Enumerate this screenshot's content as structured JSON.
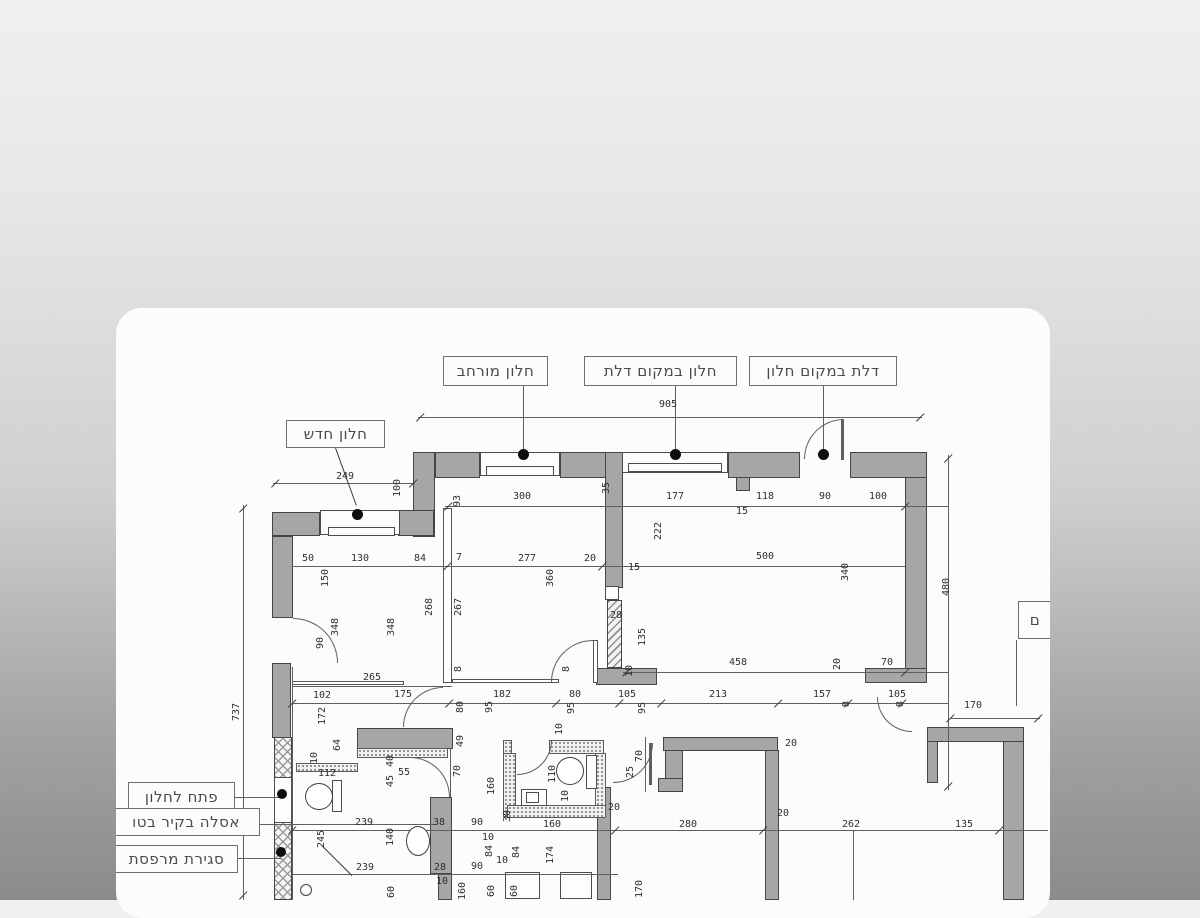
{
  "scene": {
    "background_top": "#f0f0f0",
    "background_bottom": "#8b8b8b",
    "card_color": "#fcfcfc",
    "wall_fill": "#a6a6a6",
    "ink": "#454545"
  },
  "plan": {
    "callouts": [
      {
        "t": "חלון מורחב",
        "x": 443,
        "y": 356,
        "w": 105,
        "h": 30
      },
      {
        "t": "חלון במקום דלת",
        "x": 584,
        "y": 356,
        "w": 153,
        "h": 30
      },
      {
        "t": "דלת במקום חלון",
        "x": 749,
        "y": 356,
        "w": 148,
        "h": 30
      },
      {
        "t": "חלון חדש",
        "x": 286,
        "y": 420,
        "w": 99,
        "h": 28
      },
      {
        "t": "פתח לחלון",
        "x": 128,
        "y": 782,
        "w": 107,
        "h": 30
      },
      {
        "t": "אסלה בקיר בטו",
        "x": 112,
        "y": 808,
        "w": 148,
        "h": 28
      },
      {
        "t": "סגירת מרפסת",
        "x": 115,
        "y": 845,
        "w": 123,
        "h": 28
      },
      {
        "t": "ם",
        "x": 1018,
        "y": 601,
        "w": 34,
        "h": 38
      }
    ],
    "rects": [
      [
        413,
        452,
        22,
        85,
        "w"
      ],
      [
        435,
        452,
        45,
        26,
        "w"
      ],
      [
        560,
        452,
        62,
        26,
        "w"
      ],
      [
        728,
        452,
        72,
        26,
        "w"
      ],
      [
        736,
        477,
        14,
        14,
        "w"
      ],
      [
        850,
        452,
        77,
        26,
        "w"
      ],
      [
        905,
        477,
        22,
        192,
        "w"
      ],
      [
        865,
        668,
        62,
        15,
        "w"
      ],
      [
        272,
        512,
        48,
        24,
        "w"
      ],
      [
        398,
        510,
        36,
        26,
        "w"
      ],
      [
        272,
        536,
        21,
        82,
        "w"
      ],
      [
        272,
        663,
        19,
        75,
        "w"
      ],
      [
        357,
        728,
        96,
        21,
        "w"
      ],
      [
        430,
        797,
        22,
        77,
        "w"
      ],
      [
        438,
        873,
        14,
        27,
        "w"
      ],
      [
        605,
        452,
        18,
        136,
        "w"
      ],
      [
        596,
        668,
        61,
        17,
        "w"
      ],
      [
        597,
        787,
        14,
        113,
        "w"
      ],
      [
        663,
        737,
        115,
        14,
        "w"
      ],
      [
        765,
        750,
        14,
        150,
        "w"
      ],
      [
        665,
        750,
        18,
        29,
        "w"
      ],
      [
        658,
        778,
        25,
        14,
        "w"
      ],
      [
        927,
        727,
        97,
        15,
        "w"
      ],
      [
        1003,
        741,
        21,
        159,
        "w"
      ],
      [
        927,
        741,
        11,
        42,
        "w"
      ],
      [
        607,
        600,
        15,
        68,
        "h"
      ],
      [
        274,
        737,
        18,
        41,
        "x"
      ],
      [
        274,
        822,
        18,
        78,
        "x"
      ],
      [
        357,
        748,
        91,
        10,
        "s"
      ],
      [
        296,
        763,
        62,
        9,
        "s"
      ],
      [
        503,
        740,
        9,
        14,
        "s"
      ],
      [
        549,
        740,
        55,
        14,
        "s"
      ],
      [
        503,
        753,
        13,
        64,
        "s"
      ],
      [
        595,
        753,
        11,
        57,
        "s"
      ],
      [
        507,
        805,
        99,
        13,
        "s"
      ],
      [
        480,
        452,
        80,
        24,
        "f"
      ],
      [
        486,
        466,
        68,
        10,
        "f"
      ],
      [
        622,
        452,
        106,
        21,
        "f"
      ],
      [
        628,
        463,
        94,
        9,
        "f"
      ],
      [
        320,
        510,
        80,
        25,
        "f"
      ],
      [
        328,
        527,
        67,
        9,
        "f"
      ],
      [
        274,
        777,
        18,
        46,
        "f"
      ],
      [
        605,
        586,
        14,
        14,
        "f"
      ],
      [
        505,
        872,
        35,
        27,
        "f"
      ],
      [
        560,
        872,
        32,
        27,
        "f"
      ],
      [
        332,
        780,
        10,
        32,
        "f"
      ],
      [
        586,
        755,
        11,
        34,
        "f"
      ],
      [
        521,
        789,
        26,
        17,
        "f"
      ],
      [
        526,
        792,
        13,
        11,
        "f"
      ],
      [
        443,
        508,
        9,
        175,
        "t"
      ],
      [
        292,
        681,
        112,
        4,
        "t"
      ],
      [
        452,
        679,
        107,
        4,
        "t"
      ],
      [
        593,
        640,
        5,
        43,
        "t"
      ]
    ],
    "lines": [
      [
        418,
        417,
        504,
        1
      ],
      [
        273,
        483,
        142,
        1
      ],
      [
        445,
        506,
        503,
        1
      ],
      [
        292,
        566,
        613,
        1
      ],
      [
        623,
        672,
        325,
        1
      ],
      [
        292,
        686,
        160,
        1
      ],
      [
        292,
        703,
        656,
        1
      ],
      [
        950,
        718,
        90,
        1
      ],
      [
        292,
        830,
        756,
        1
      ],
      [
        292,
        874,
        326,
        1
      ],
      [
        243,
        505,
        1,
        395
      ],
      [
        948,
        455,
        1,
        335
      ],
      [
        853,
        830,
        1,
        70
      ],
      [
        645,
        737,
        1,
        55
      ],
      [
        523,
        386,
        1,
        66
      ],
      [
        675,
        386,
        1,
        66
      ],
      [
        823,
        386,
        1,
        66
      ],
      [
        235,
        797,
        46,
        1
      ],
      [
        260,
        824,
        175,
        1
      ],
      [
        238,
        858,
        43,
        1
      ],
      [
        1016,
        640,
        1,
        66
      ],
      [
        649,
        743,
        3,
        42
      ],
      [
        841,
        419,
        3,
        41
      ],
      [
        292,
        667,
        1,
        233
      ],
      [
        450,
        748,
        1,
        50
      ]
    ],
    "arcs": [
      [
        293,
        618,
        45,
        "tr"
      ],
      [
        403,
        687,
        40,
        "tl"
      ],
      [
        410,
        757,
        40,
        "tr"
      ],
      [
        517,
        740,
        35,
        "br"
      ],
      [
        613,
        743,
        40,
        "br"
      ],
      [
        804,
        419,
        40,
        "tl"
      ],
      [
        877,
        697,
        35,
        "bl"
      ],
      [
        551,
        640,
        42,
        "tl"
      ]
    ],
    "dots": [
      [
        523,
        454,
        11
      ],
      [
        675,
        454,
        11
      ],
      [
        823,
        454,
        11
      ],
      [
        357,
        514,
        11
      ],
      [
        282,
        794,
        10
      ],
      [
        281,
        852,
        10
      ],
      [
        414,
        838,
        5
      ]
    ],
    "ellipses": [
      [
        305,
        783,
        28,
        27
      ],
      [
        556,
        757,
        28,
        28
      ],
      [
        406,
        826,
        24,
        30
      ],
      [
        300,
        884,
        12,
        12
      ]
    ],
    "diags": [
      [
        336,
        448,
        61,
        70
      ],
      [
        322,
        845,
        43,
        45
      ]
    ],
    "ticks": [
      [
        416,
        421
      ],
      [
        916,
        421
      ],
      [
        271,
        487
      ],
      [
        409,
        487
      ],
      [
        944,
        462
      ],
      [
        944,
        790
      ],
      [
        946,
        722
      ],
      [
        1034,
        722
      ],
      [
        288,
        707
      ],
      [
        445,
        707
      ],
      [
        552,
        707
      ],
      [
        615,
        707
      ],
      [
        657,
        707
      ],
      [
        774,
        707
      ],
      [
        844,
        707
      ],
      [
        898,
        707
      ],
      [
        288,
        834
      ],
      [
        611,
        834
      ],
      [
        759,
        834
      ],
      [
        995,
        834
      ],
      [
        443,
        570
      ],
      [
        598,
        570
      ],
      [
        239,
        512
      ],
      [
        239,
        899
      ],
      [
        444,
        510
      ],
      [
        901,
        510
      ],
      [
        622,
        676
      ],
      [
        901,
        676
      ]
    ],
    "dims": [
      [
        "905",
        668,
        405,
        0
      ],
      [
        "249",
        345,
        477,
        0
      ],
      [
        "100",
        398,
        488,
        1
      ],
      [
        "93",
        458,
        501,
        1
      ],
      [
        "300",
        522,
        497,
        0
      ],
      [
        "177",
        675,
        497,
        0
      ],
      [
        "118",
        765,
        497,
        0
      ],
      [
        "90",
        825,
        497,
        0
      ],
      [
        "100",
        878,
        497,
        0
      ],
      [
        "15",
        742,
        512,
        0
      ],
      [
        "35",
        607,
        488,
        1
      ],
      [
        "222",
        659,
        531,
        1
      ],
      [
        "15",
        634,
        568,
        0
      ],
      [
        "500",
        765,
        557,
        0
      ],
      [
        "340",
        846,
        572,
        1
      ],
      [
        "480",
        947,
        587,
        1
      ],
      [
        "50",
        308,
        559,
        0
      ],
      [
        "130",
        360,
        559,
        0
      ],
      [
        "84",
        420,
        559,
        0
      ],
      [
        "7",
        459,
        558,
        0
      ],
      [
        "277",
        527,
        559,
        0
      ],
      [
        "20",
        590,
        559,
        0
      ],
      [
        "150",
        326,
        578,
        1
      ],
      [
        "348",
        336,
        627,
        1
      ],
      [
        "348",
        392,
        627,
        1
      ],
      [
        "268",
        430,
        607,
        1
      ],
      [
        "267",
        459,
        607,
        1
      ],
      [
        "360",
        551,
        578,
        1
      ],
      [
        "90",
        321,
        643,
        1
      ],
      [
        "28",
        616,
        616,
        0
      ],
      [
        "135",
        643,
        637,
        1
      ],
      [
        "265",
        372,
        678,
        0
      ],
      [
        "8",
        459,
        669,
        1
      ],
      [
        "8",
        567,
        669,
        1
      ],
      [
        "10",
        630,
        671,
        1
      ],
      [
        "458",
        738,
        663,
        0
      ],
      [
        "70",
        887,
        663,
        0
      ],
      [
        "20",
        838,
        664,
        1
      ],
      [
        "102",
        322,
        696,
        0
      ],
      [
        "175",
        403,
        695,
        0
      ],
      [
        "182",
        502,
        695,
        0
      ],
      [
        "80",
        575,
        695,
        0
      ],
      [
        "105",
        627,
        695,
        0
      ],
      [
        "213",
        718,
        695,
        0
      ],
      [
        "157",
        822,
        695,
        0
      ],
      [
        "105",
        897,
        695,
        0
      ],
      [
        "80",
        461,
        707,
        1
      ],
      [
        "95",
        490,
        707,
        1
      ],
      [
        "95",
        572,
        708,
        1
      ],
      [
        "95",
        643,
        708,
        1
      ],
      [
        "8",
        847,
        704,
        1
      ],
      [
        "8",
        901,
        704,
        1
      ],
      [
        "170",
        973,
        706,
        0
      ],
      [
        "737",
        237,
        712,
        1
      ],
      [
        "172",
        323,
        716,
        1
      ],
      [
        "64",
        338,
        745,
        1
      ],
      [
        "10",
        315,
        758,
        1
      ],
      [
        "112",
        327,
        774,
        0
      ],
      [
        "40",
        391,
        761,
        1
      ],
      [
        "45",
        391,
        781,
        1
      ],
      [
        "55",
        404,
        773,
        0
      ],
      [
        "49",
        461,
        741,
        1
      ],
      [
        "70",
        458,
        771,
        1
      ],
      [
        "10",
        560,
        729,
        1
      ],
      [
        "110",
        553,
        774,
        1
      ],
      [
        "160",
        492,
        786,
        1
      ],
      [
        "10",
        566,
        796,
        1
      ],
      [
        "30",
        508,
        816,
        1
      ],
      [
        "90",
        477,
        823,
        0
      ],
      [
        "160",
        552,
        825,
        0
      ],
      [
        "20",
        614,
        808,
        0
      ],
      [
        "25",
        631,
        772,
        1
      ],
      [
        "70",
        640,
        756,
        1
      ],
      [
        "20",
        791,
        744,
        0
      ],
      [
        "20",
        783,
        814,
        0
      ],
      [
        "280",
        688,
        825,
        0
      ],
      [
        "262",
        851,
        825,
        0
      ],
      [
        "135",
        964,
        825,
        0
      ],
      [
        "239",
        364,
        823,
        0
      ],
      [
        "239",
        365,
        868,
        0
      ],
      [
        "245",
        322,
        839,
        1
      ],
      [
        "140",
        391,
        837,
        1
      ],
      [
        "38",
        439,
        823,
        0
      ],
      [
        "28",
        440,
        868,
        0
      ],
      [
        "10",
        442,
        882,
        0
      ],
      [
        "90",
        477,
        867,
        0
      ],
      [
        "10",
        488,
        838,
        0
      ],
      [
        "84",
        490,
        851,
        1
      ],
      [
        "84",
        517,
        852,
        1
      ],
      [
        "10",
        502,
        861,
        0
      ],
      [
        "174",
        551,
        855,
        1
      ],
      [
        "60",
        392,
        892,
        1
      ],
      [
        "160",
        463,
        891,
        1
      ],
      [
        "60",
        492,
        891,
        1
      ],
      [
        "60",
        515,
        891,
        1
      ],
      [
        "170",
        640,
        889,
        1
      ]
    ]
  }
}
